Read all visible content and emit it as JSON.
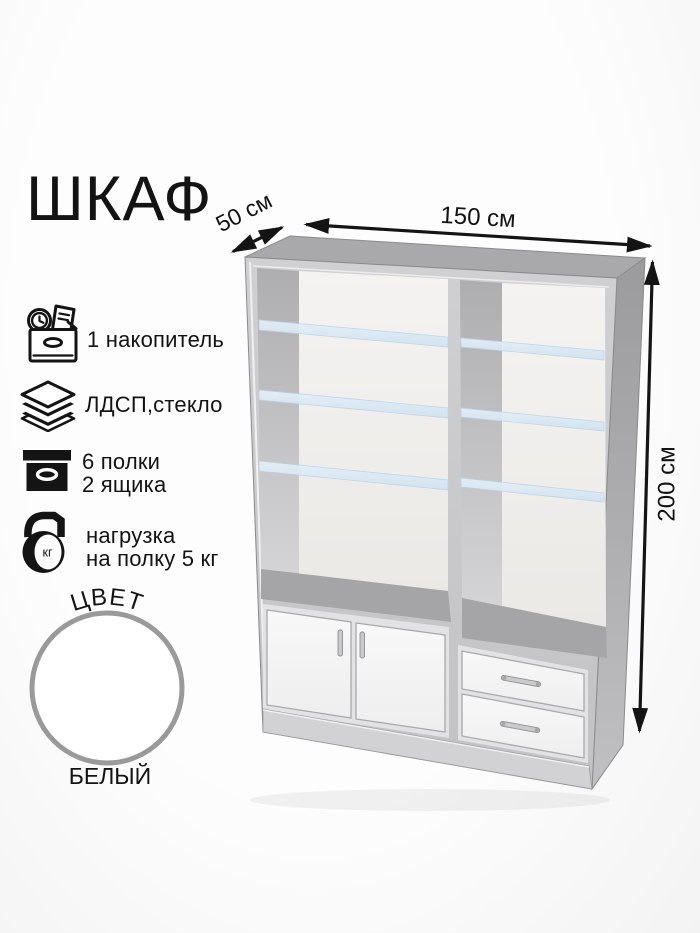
{
  "title": "ШКАФ",
  "dimensions": {
    "depth_label": "50 см",
    "width_label": "150 см",
    "height_label": "200 см"
  },
  "features": [
    {
      "icon": "storage-box-icon",
      "lines": [
        "1 накопитель"
      ]
    },
    {
      "icon": "material-layers-icon",
      "lines": [
        "ЛДСП,стекло"
      ]
    },
    {
      "icon": "drawer-box-icon",
      "lines": [
        "6 полки",
        "2 ящика"
      ]
    },
    {
      "icon": "kettlebell-weight-icon",
      "lines": [
        "нагрузка",
        "на полку 5 кг"
      ],
      "icon_label": "кг"
    }
  ],
  "color": {
    "label": "ЦВЕТ",
    "value": "БЕЛЫЙ",
    "swatch_hex": "#ffffff",
    "swatch_border_hex": "#9a9a9a"
  },
  "illustration": {
    "type": "cabinet-3d-render",
    "upper_glass_shelves_left": 3,
    "upper_glass_shelves_right": 3,
    "doors": 2,
    "drawers": 2
  },
  "palette": {
    "background": "#fbfbfb",
    "line": "#141414",
    "cabinet_top": "#a9a9ab",
    "cabinet_side": "#a0a0a2",
    "cabinet_frame": "#c9c9cb",
    "interior_wall": "#b3b3b5",
    "interior_back": "#f3f2f0",
    "interior_floor": "#a5a5a7",
    "glass_shelf": "#d9e8f4",
    "door_front": "#f6f6f6",
    "plinth": "#d2d2d4"
  }
}
